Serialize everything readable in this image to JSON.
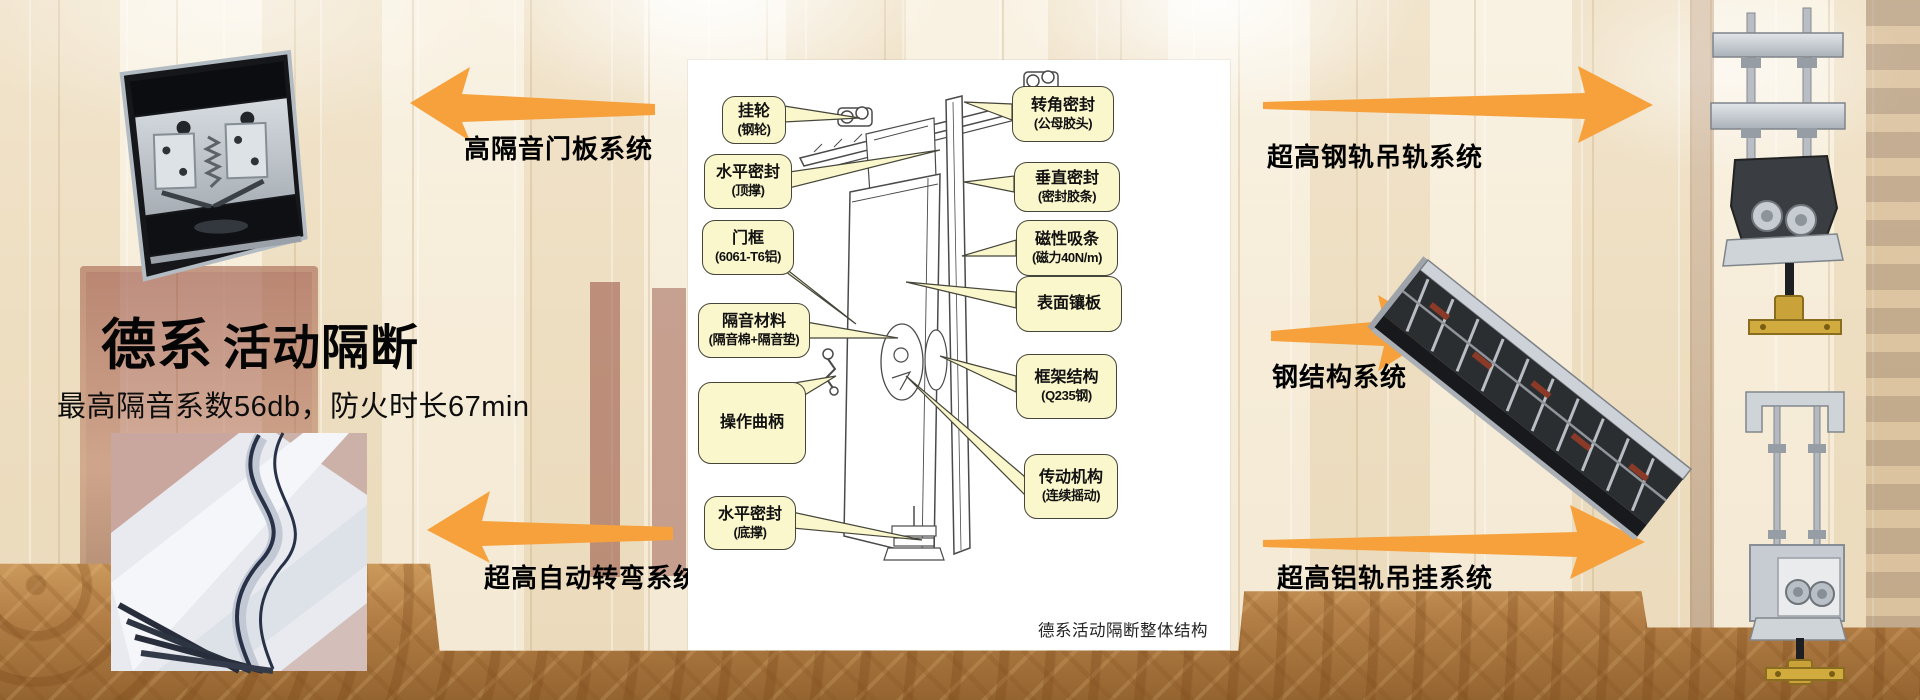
{
  "colors": {
    "arrow_orange": "#F6A13C",
    "callout_fill": "#FBF7CC",
    "callout_border": "#45453A",
    "panel_white": "#FFFFFF"
  },
  "hero": {
    "title_bold": "德系",
    "title_rest": "活动隔断",
    "subtitle": "最高隔音系数56db，防火时长67min"
  },
  "systems": {
    "door_panel": "高隔音门板系统",
    "auto_turn": "超高自动转弯系统",
    "steel_rail": "超高钢轨吊轨系统",
    "steel_structure": "钢结构系统",
    "aluminum_rail": "超高铝轨吊挂系统"
  },
  "diagram": {
    "caption": "德系活动隔断整体结构",
    "callouts_left": [
      {
        "text": "挂轮",
        "sub": "(钢轮)"
      },
      {
        "text": "水平密封",
        "sub": "(顶撑)"
      },
      {
        "text": "门框",
        "sub": "(6061-T6铝)"
      },
      {
        "text": "隔音材料",
        "sub": "(隔音棉+隔音垫)"
      },
      {
        "text": "操作曲柄",
        "sub": ""
      },
      {
        "text": "水平密封",
        "sub": "(底撑)"
      }
    ],
    "callouts_right": [
      {
        "text": "转角密封",
        "sub": "(公母胶头)"
      },
      {
        "text": "垂直密封",
        "sub": "(密封胶条)"
      },
      {
        "text": "磁性吸条",
        "sub": "(磁力40N/m)"
      },
      {
        "text": "表面镶板",
        "sub": ""
      },
      {
        "text": "框架结构",
        "sub": "(Q235钢)"
      },
      {
        "text": "传动机构",
        "sub": "(连续摇动)"
      }
    ]
  }
}
